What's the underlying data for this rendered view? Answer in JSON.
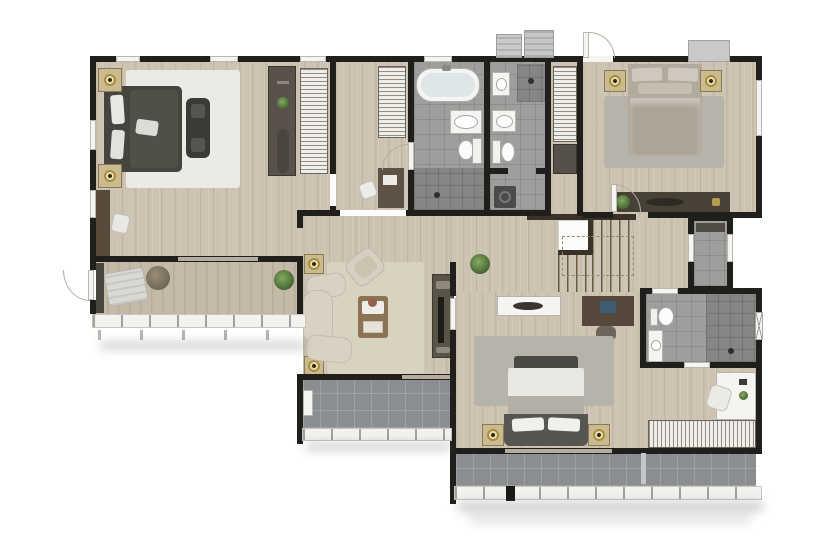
{
  "meta": {
    "description": "3D-rendered top-down apartment floor plan, photographic style, no text labels",
    "canvas": {
      "width": 835,
      "height": 550
    }
  },
  "palette": {
    "wall": "#201f1c",
    "wood": "#cdc3b2",
    "wood_deck": "#c5baa8",
    "tile": "#9e9e9c",
    "tile_dark": "#868583",
    "btile": "#8b8e90",
    "rug_white": "#eceae5",
    "rug_beige": "#d8d2c1",
    "rug_gray": "#b6b3ab",
    "bed_dark": "#45443e",
    "bed_beige": "#b2aa9d",
    "sofa": "#d8d2c3",
    "wood_furn": "#5d5244",
    "wood_furn_light": "#8b7355",
    "cabinet_dark": "#474136",
    "white": "#f5f4f1",
    "gold": "#a98c36",
    "plant": "#54763c",
    "rail": "#f3f2ee",
    "tread": "#6a5a42",
    "slider": "#b5ada0",
    "shadow": "rgba(80,80,78,0.30)"
  },
  "rooms": [
    {
      "id": "master-bedroom",
      "label": "Master bedroom",
      "floor": "wood"
    },
    {
      "id": "dressing-hall",
      "label": "Dressing hall",
      "floor": "wood"
    },
    {
      "id": "master-bathroom",
      "label": "Master bathroom",
      "floor": "gray tile"
    },
    {
      "id": "bathroom-2",
      "label": "Bathroom 2",
      "floor": "gray tile"
    },
    {
      "id": "entry-foyer",
      "label": "Entry foyer / closet",
      "floor": "wood"
    },
    {
      "id": "bedroom-2",
      "label": "Bedroom 2",
      "floor": "wood"
    },
    {
      "id": "hallway",
      "label": "Hallway",
      "floor": "wood"
    },
    {
      "id": "staircase",
      "label": "Staircase",
      "floor": "wood with treads"
    },
    {
      "id": "utility-room",
      "label": "Utility room",
      "floor": "gray tile"
    },
    {
      "id": "living-room",
      "label": "Living room",
      "floor": "wood"
    },
    {
      "id": "bedroom-3",
      "label": "Bedroom 3",
      "floor": "wood"
    },
    {
      "id": "bathroom-3",
      "label": "En-suite bathroom 3",
      "floor": "gray tile"
    },
    {
      "id": "balcony-left",
      "label": "Left balcony",
      "floor": "wood deck"
    },
    {
      "id": "balcony-center",
      "label": "Center balcony",
      "floor": "gray tile"
    },
    {
      "id": "balcony-bottom",
      "label": "Bottom balcony",
      "floor": "gray tile"
    }
  ],
  "furniture": {
    "master-bedroom": [
      "dark double bed with white pillows",
      "white shag rug",
      "2 nightstands with gold lamps",
      "foot bench",
      "wall desk with chair",
      "wardrobe cabinet",
      "shelved closet"
    ],
    "dressing-hall": [
      "shelved closet",
      "small desk with chair"
    ],
    "master-bathroom": [
      "bathtub",
      "vanity with oval sink",
      "toilet",
      "walk-in shower"
    ],
    "bathroom-2": [
      "washbasin",
      "vanity with oval sink",
      "toilet",
      "corner shower",
      "washer"
    ],
    "entry-foyer": [
      "shelved closet",
      "shoe cabinet"
    ],
    "bedroom-2": [
      "beige double bed",
      "gray rug",
      "2 nightstands with gold lamps",
      "long dresser with plant and tray"
    ],
    "staircase": [
      "two flights of treads",
      "white landing",
      "dark wood railing",
      "dashed walk line"
    ],
    "utility-room": [
      "wall shelf"
    ],
    "living-room": [
      "cream curved L-sofa",
      "rotated armchair",
      "beige rug",
      "wood coffee table with tray and flowers",
      "TV sideboard with TV",
      "2 gold floor lamps",
      "potted plant"
    ],
    "bedroom-3": [
      "bed with gray headboard and white linens",
      "gray rug",
      "2 nightstands with gold lamps",
      "white sideboard with bowl",
      "dark desk with laptop and chair",
      "white corner desk with chair",
      "long striped wardrobe"
    ],
    "bathroom-3": [
      "toilet",
      "vanity with round sink",
      "dark tiled shower with head"
    ],
    "balcony-left": [
      "chaise lounge",
      "round pouf",
      "potted plant",
      "dark planter"
    ],
    "balcony-center": [
      "white utility box"
    ],
    "balcony-bottom": [
      "glass divider",
      "black post"
    ]
  },
  "fixtures": {
    "doors": [
      "main entry with swing arc (top)",
      "master bedroom door",
      "master bathroom door with arc",
      "bedroom 2 door with arc",
      "bedroom 3 doorway",
      "bathroom 3 doors x2",
      "utility room doors x2",
      "left balcony door with arc",
      "master-balcony sliding door",
      "living-balcony sliding door",
      "bedroom3-balcony sliding door"
    ],
    "windows": [
      "master top wall x3",
      "bathroom top wall",
      "master left wall x2",
      "bedroom 2 right wall",
      "bathroom 3 right wall (cross pane)"
    ],
    "ac_units": 3,
    "stairs": {
      "flights": 2,
      "landing": true
    },
    "railings": [
      "left balcony",
      "center balcony",
      "bottom balcony"
    ]
  }
}
